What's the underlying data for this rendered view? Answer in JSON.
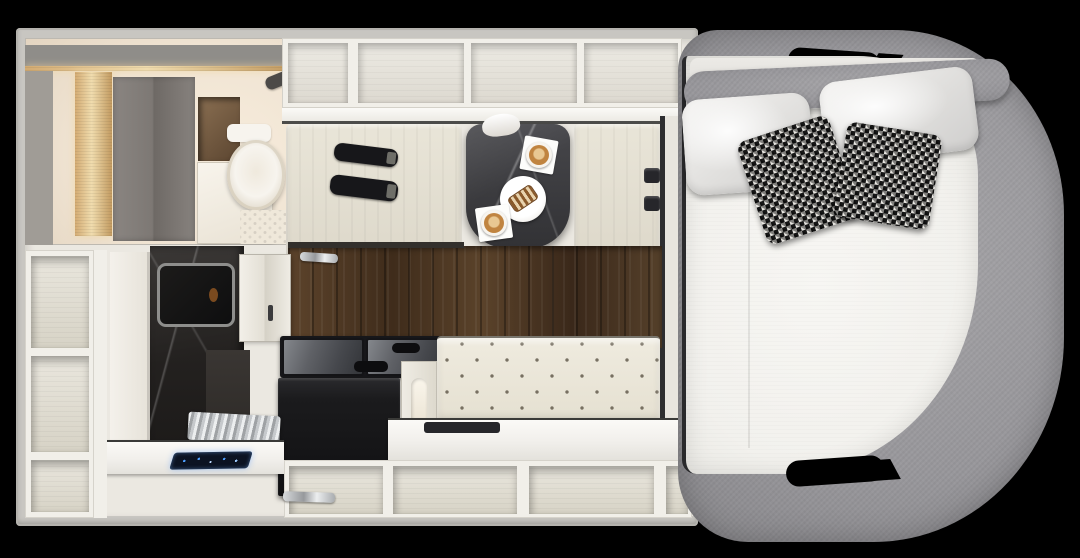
{
  "scene": {
    "name": "rv-camper-floor-plan-top-view",
    "view": "overhead-3d-render",
    "background": "#000000"
  },
  "palette": {
    "bg": "#000000",
    "wall": "#c8c6c1",
    "room": "#ebe8e1",
    "cream": "#f1efe9",
    "cell": "#e7e4dc",
    "wood-a": "#5c432b",
    "wood-b": "#3f2c1b",
    "wood-floor-base": "#4e3926",
    "marble-table": "#3b3b3e",
    "marble-shower": "#242120",
    "bench": "#e9e5d8",
    "sofa": "#efebdf",
    "belt": "#17171a",
    "appliance": "#1b1b1d",
    "glass-a": "#84878c",
    "glass-b": "#333539",
    "mattress": "#f2f1ed",
    "fabric": "#98979b",
    "fabric-dark": "#7c7b7f",
    "pillow-a": "#f5f4f2",
    "pillow-b": "#cfcecd",
    "hound-dark": "#161616",
    "hound-light": "#e9e7e2",
    "coffee": "#c08440",
    "crema": "#e9c892",
    "navy": "#0c1322",
    "blue": "#4e9fff",
    "gold": "#d9b886",
    "wardrobe": "#7d7874",
    "bath-warm": "#f0e4d3",
    "chrome-a": "#d7dadc",
    "chrome-b": "#97999c",
    "toilet": "#f7f4ee",
    "trim-dark": "#2e2e30",
    "amber": "#7a4a1f"
  },
  "interior": {
    "bathroom": {
      "items": [
        "wardrobe-double-door",
        "storage-niche",
        "door-panel",
        "toilet",
        "hex-tile-floor",
        "shower-head",
        "led-light-strip"
      ]
    },
    "overhead_shelves": {
      "compartments": 4
    },
    "dinette": {
      "benches": 2,
      "seat_belts_left_bench": 2,
      "buckles_right_bench": 2,
      "table_material": "dark-marble",
      "table_items": [
        "coffee-cup-on-napkin",
        "pastry-plate",
        "coffee-cup-on-napkin"
      ]
    },
    "kitchen": {
      "items": [
        "marble-shower-column",
        "skylight-window",
        "upper-cabinet-two-door",
        "cooktop-glass-lids",
        "black-appliance",
        "sink-counter",
        "chrome-drain-rack",
        "touch-control-panel",
        "grab-handle"
      ]
    },
    "lounge": {
      "items": [
        "tufted-sofa",
        "side-counter",
        "serving-tray"
      ]
    },
    "storage": {
      "left_column_compartments": 3,
      "bottom_row_compartments": 4
    }
  },
  "bed_area": {
    "surround": "gray-upholstered-frame",
    "mattress_sections": 2,
    "pillows_white": 2,
    "pillows_houndstooth": 2,
    "handle_cutouts": 2
  }
}
